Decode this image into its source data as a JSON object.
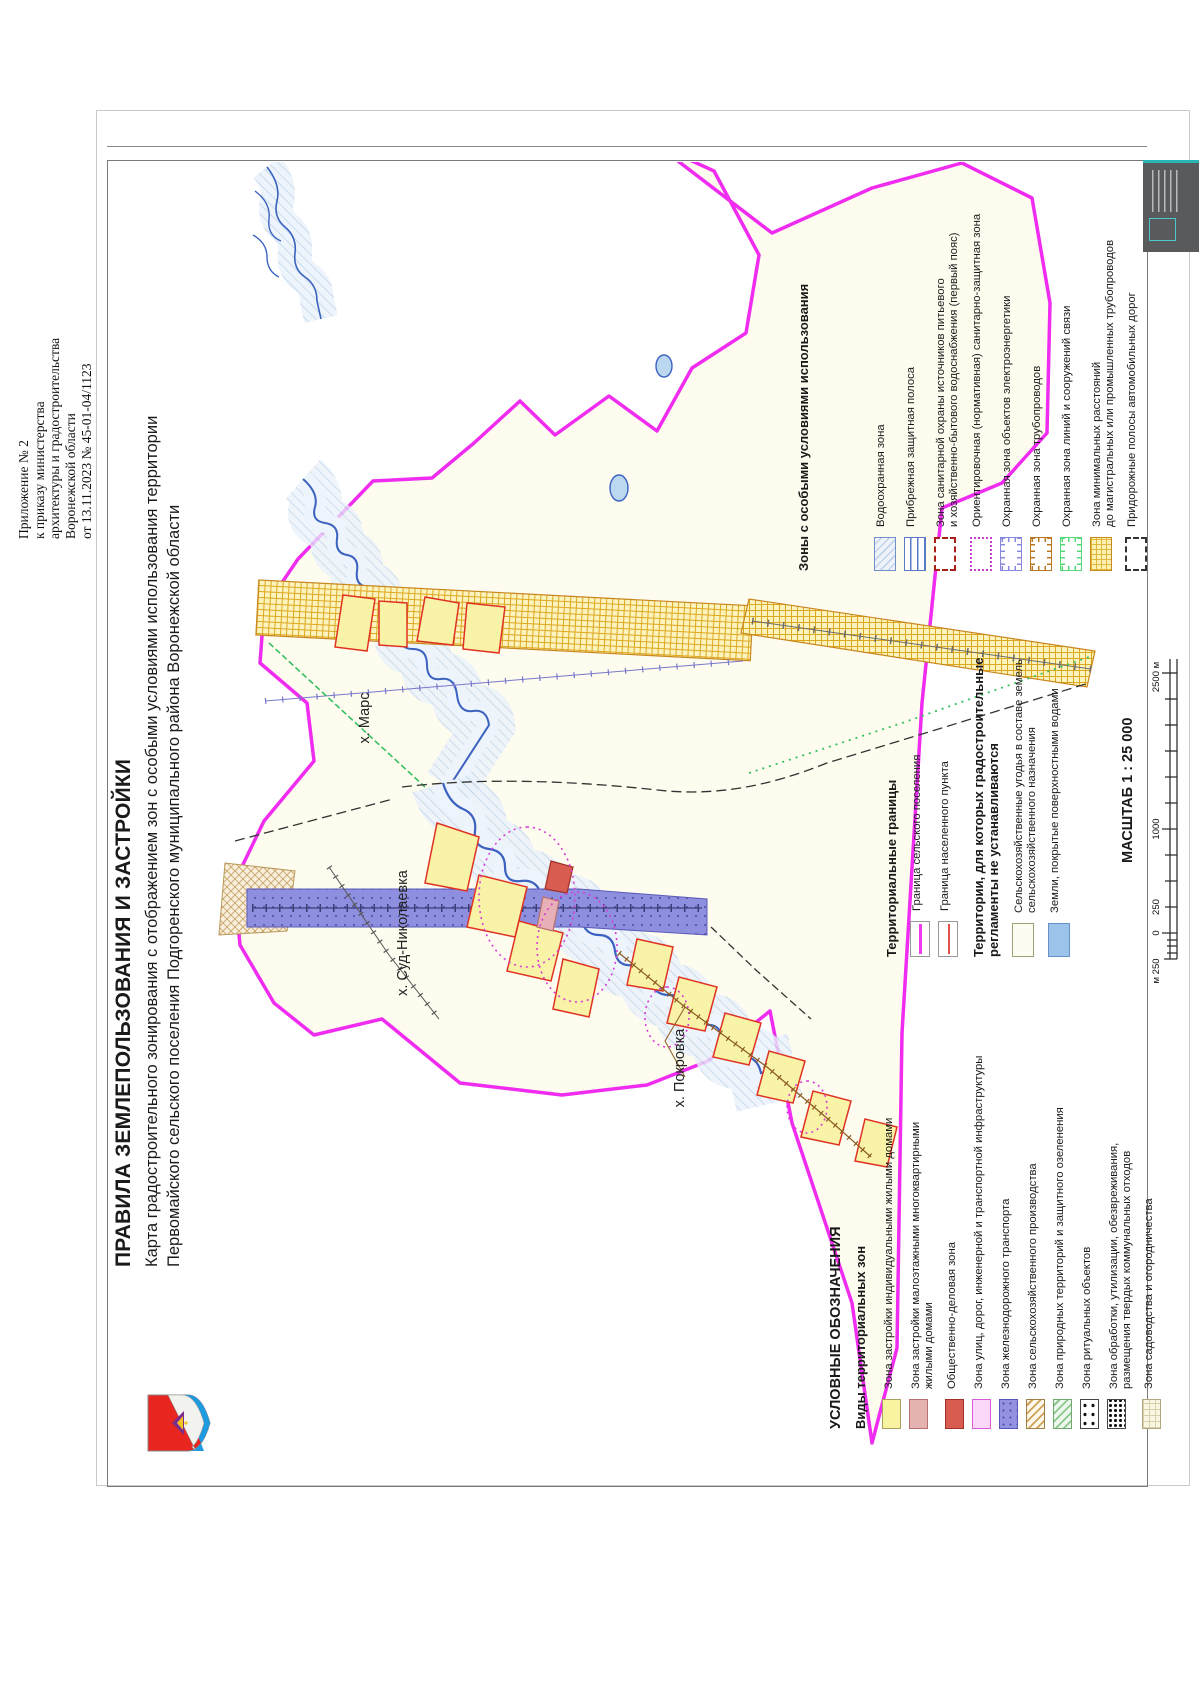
{
  "header_note": {
    "lines": [
      "Приложение № 2",
      "к приказу министерства",
      "архитектуры и градостроительства",
      "Воронежской области",
      "от 13.11.2023 № 45-01-04/1123"
    ]
  },
  "title": {
    "line1": "ПРАВИЛА ЗЕМЛЕПОЛЬЗОВАНИЯ И ЗАСТРОЙКИ",
    "line2": "Карта градостроительного зонирования с отображением зон с особыми условиями использования территории",
    "line3": "Первомайского сельского поселения Подгоренского муниципального района Воронежской области"
  },
  "map": {
    "labels": [
      "х. Марс",
      "х. Суд-Николаевка",
      "х. Покровка"
    ]
  },
  "legend": {
    "zones": {
      "heading": "УСЛОВНЫЕ ОБОЗНАЧЕНИЯ",
      "subheading": "Виды территориальных зон",
      "items": [
        {
          "label": "Зона застройки индивидуальными жилыми домами",
          "swatch": "sw-res-ind"
        },
        {
          "label": "Зона застройки малоэтажными многоквартирными\nжилыми домами",
          "swatch": "sw-res-multi"
        },
        {
          "label": "Общественно-деловая зона",
          "swatch": "sw-business"
        },
        {
          "label": "Зона улиц, дорог, инженерной и транспортной инфраструктуры",
          "swatch": "sw-streets"
        },
        {
          "label": "Зона железнодорожного транспорта",
          "swatch": "sw-rail"
        },
        {
          "label": "Зона сельскохозяйственного производства",
          "swatch": "sw-agro"
        },
        {
          "label": "Зона природных территорий и защитного озеленения",
          "swatch": "sw-nature"
        },
        {
          "label": "Зона ритуальных объектов",
          "swatch": "sw-ritual"
        },
        {
          "label": "Зона обработки, утилизации, обезвреживания,\nразмещения твердых коммунальных отходов",
          "swatch": "sw-waste"
        },
        {
          "label": "Зона садоводства и огородничества",
          "swatch": "sw-garden"
        }
      ]
    },
    "boundaries": {
      "heading": "Территориальные границы",
      "items": [
        {
          "label": "Граница сельского поселения",
          "swatch": "sw-line-mag"
        },
        {
          "label": "Граница населенного пункта",
          "swatch": "sw-line-red"
        }
      ]
    },
    "noreg": {
      "heading": "Территории, для которых градостроительные\nрегламенты не устанавливаются",
      "items": [
        {
          "label": "Сельскохозяйственные угодья в составе земель\nсельскохозяйственного назначения",
          "swatch": "sw-agri-land"
        },
        {
          "label": "Земли, покрытые поверхностными водами",
          "swatch": "sw-water-land"
        }
      ]
    },
    "zouit": {
      "heading": "Зоны с особыми условиями использования",
      "items": [
        {
          "label": "Водоохранная зона",
          "swatch": "sw-waterprot"
        },
        {
          "label": "Прибрежная защитная полоса",
          "swatch": "sw-coastal"
        },
        {
          "label": "Зона санитарной охраны источников питьевого\nи хозяйственно-бытового водоснабжения (первый пояс)",
          "swatch": "sw-sanwater"
        },
        {
          "label": "Ориентировочная (нормативная) санитарно-защитная зона",
          "swatch": "sw-szz"
        },
        {
          "label": "Охранная зона объектов электроэнергетики",
          "swatch": "sw-tick sw-electro"
        },
        {
          "label": "Охранная зона трубопроводов",
          "swatch": "sw-tick sw-pipe"
        },
        {
          "label": "Охранная зона линий и сооружений связи",
          "swatch": "sw-tick sw-comm"
        },
        {
          "label": "Зона минимальных расстояний\nдо магистральных или промышленных трубопроводов",
          "swatch": "sw-mindist"
        },
        {
          "label": "Придорожные полосы автомобильных дорог",
          "swatch": "sw-roadside"
        }
      ]
    }
  },
  "scale": {
    "title": "МАСШТАБ 1 : 25 000",
    "ticks": [
      "м 250",
      "0",
      "250",
      "1000",
      "2500 м"
    ]
  },
  "colors": {
    "settlement_boundary": "#ee3cee",
    "locality_boundary": "#e05048",
    "zone_yellow": "#f7f3a0",
    "rail_zone": "#9292e0",
    "water": "#3c62c0",
    "stamp_teal": "#2ab5b5"
  }
}
